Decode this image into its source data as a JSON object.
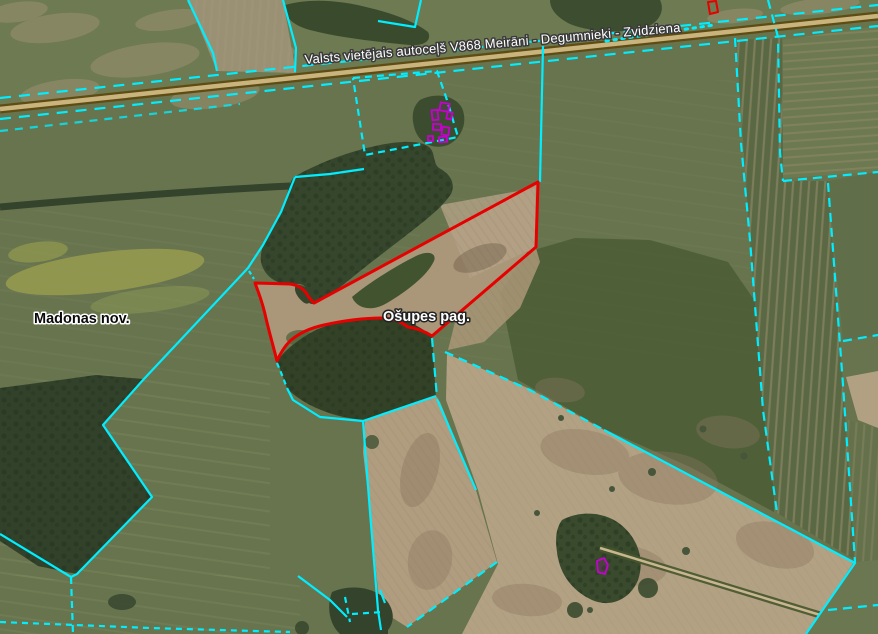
{
  "map": {
    "labels": {
      "road": "Valsts vietējais autoceļš V868 Meirāni - Degumnieki - Zvidziena",
      "municipality": "Madonas nov.",
      "parish": "Ošupes pag."
    },
    "colors": {
      "cadastral_boundary": "#00eeff",
      "selected_parcel_outline": "#e60000",
      "building_outline": "#c303cc",
      "road_casing": "#5e4c13",
      "road_surface": "#c9b47e"
    }
  }
}
